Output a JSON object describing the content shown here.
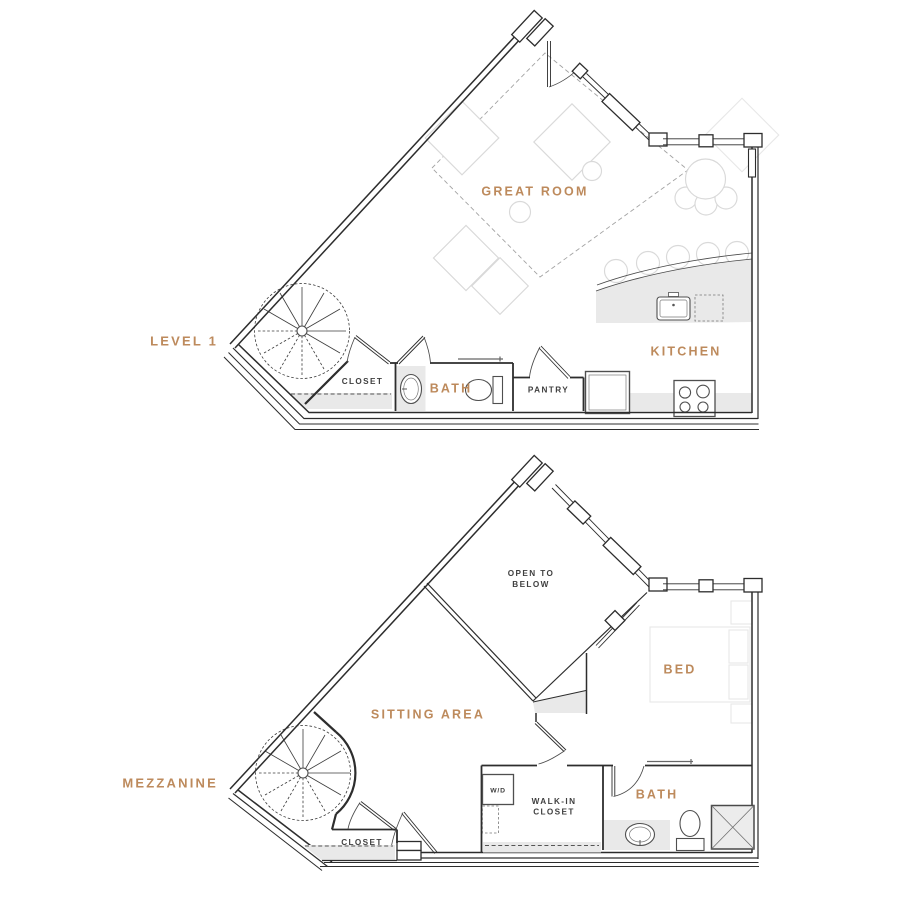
{
  "colors": {
    "accent": "#bd8a5c",
    "ink": "#3f3f3f",
    "wall": "#2d2d2d",
    "light_fill": "#e9e9e9"
  },
  "level1": {
    "title": "LEVEL 1",
    "rooms": {
      "great_room": "GREAT ROOM",
      "kitchen": "KITCHEN",
      "closet": "CLOSET",
      "bath": "BATH",
      "pantry": "PANTRY"
    }
  },
  "mezzanine": {
    "title": "MEZZANINE",
    "rooms": {
      "open_to_below_line1": "OPEN TO",
      "open_to_below_line2": "BELOW",
      "sitting_area": "SITTING AREA",
      "bed": "BED",
      "bath": "BATH",
      "walk_in_closet_line1": "WALK-IN",
      "walk_in_closet_line2": "CLOSET",
      "closet": "CLOSET",
      "washer_dryer": "W/D"
    }
  }
}
